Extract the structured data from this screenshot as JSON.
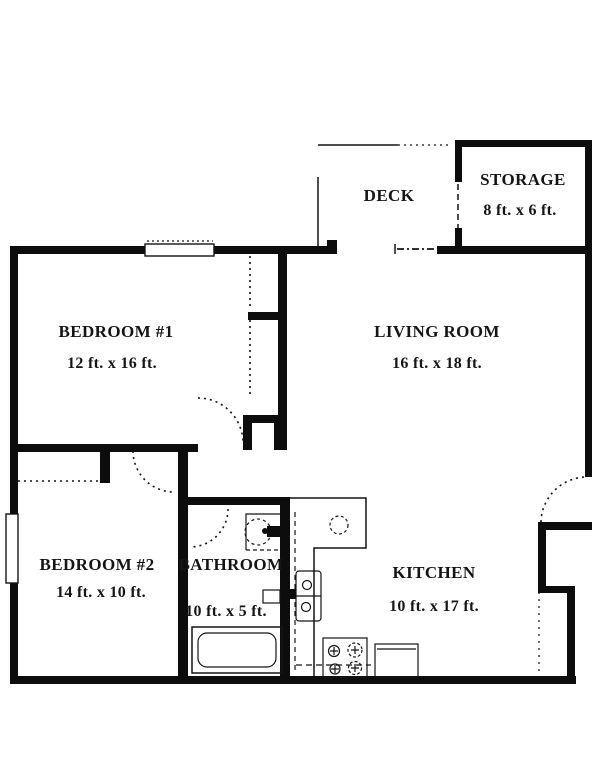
{
  "plan": {
    "rooms": [
      {
        "name": "DECK",
        "dims": ""
      },
      {
        "name": "STORAGE",
        "dims": "8 ft. x 6 ft."
      },
      {
        "name": "BEDROOM #1",
        "dims": "12 ft. x 16 ft."
      },
      {
        "name": "LIVING ROOM",
        "dims": "16 ft. x 18 ft."
      },
      {
        "name": "BEDROOM #2",
        "dims": "14 ft. x 10 ft."
      },
      {
        "name": "BATHROOM",
        "dims": "10 ft. x 5 ft."
      },
      {
        "name": "KITCHEN",
        "dims": "10 ft. x 17 ft."
      }
    ],
    "fixtures": [
      "bathroom-sink",
      "bathtub",
      "kitchen-sink",
      "range-burners",
      "appliance",
      "cabinet"
    ],
    "colors": {
      "wall": "#000000",
      "background": "#ffffff"
    }
  }
}
